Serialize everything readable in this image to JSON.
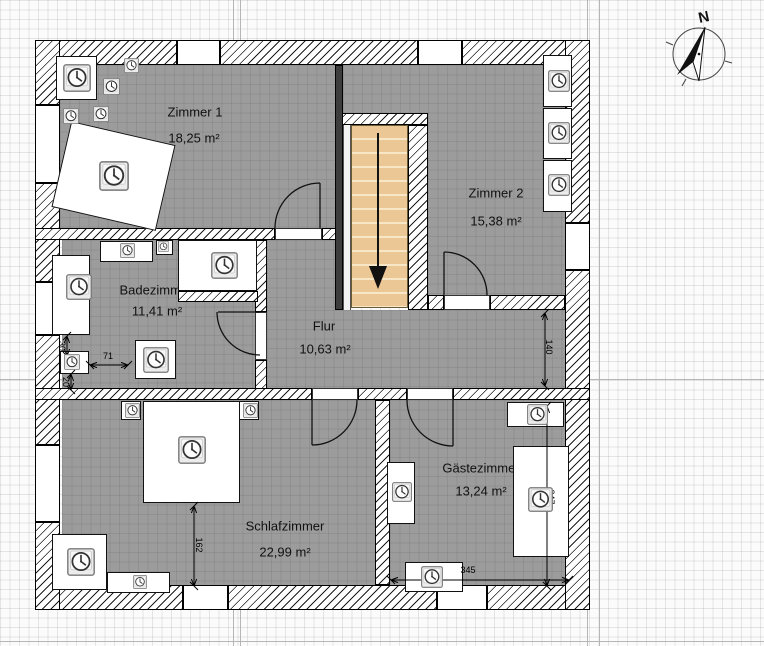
{
  "view": {
    "type": "floor-plan",
    "units": "cm"
  },
  "compass": {
    "label": "N"
  },
  "colors": {
    "room_fill": "#9c9c9c",
    "stair_fill": "#ebc795",
    "wall_hatch": "#1c1c1c",
    "window_fill": "#ffffff",
    "annotation": "#000000"
  },
  "rooms": [
    {
      "id": "zimmer1",
      "name": "Zimmer 1",
      "area": "18,25 m²",
      "label_x": 195,
      "label_y": 112,
      "area_x": 194,
      "area_y": 138
    },
    {
      "id": "zimmer2",
      "name": "Zimmer 2",
      "area": "15,38 m²",
      "label_x": 496,
      "label_y": 193,
      "area_x": 496,
      "area_y": 221
    },
    {
      "id": "badezimmer",
      "name": "Badezimmer",
      "area": "11,41 m²",
      "label_x": 156,
      "label_y": 290,
      "area_x": 157,
      "area_y": 311
    },
    {
      "id": "flur",
      "name": "Flur",
      "area": "10,63 m²",
      "label_x": 324,
      "label_y": 326,
      "area_x": 325,
      "area_y": 349
    },
    {
      "id": "schlafzimmer",
      "name": "Schlafzimmer",
      "area": "22,99 m²",
      "label_x": 285,
      "label_y": 526,
      "area_x": 285,
      "area_y": 552
    },
    {
      "id": "gaestezimmer",
      "name": "Gästezimmer",
      "area": "13,24 m²",
      "label_x": 481,
      "label_y": 468,
      "area_x": 481,
      "area_y": 491
    }
  ],
  "dimensions": [
    {
      "id": "flur-height",
      "value": "140",
      "x1": 545,
      "y1": 313,
      "x2": 545,
      "y2": 386,
      "lx": 549,
      "ly": 347,
      "rot": 90
    },
    {
      "id": "bett-abstand",
      "value": "162",
      "x1": 194,
      "y1": 506,
      "x2": 194,
      "y2": 586,
      "lx": 199,
      "ly": 545,
      "rot": 90
    },
    {
      "id": "gaeste-hoehe",
      "value": "347",
      "x1": 547,
      "y1": 406,
      "x2": 547,
      "y2": 586,
      "lx": 551,
      "ly": 497,
      "rot": 90
    },
    {
      "id": "gaeste-breite",
      "value": "345",
      "x1": 391,
      "y1": 580,
      "x2": 569,
      "y2": 580,
      "lx": 468,
      "ly": 570,
      "rot": 0
    },
    {
      "id": "bad-71",
      "value": "71",
      "x1": 90,
      "y1": 365,
      "x2": 128,
      "y2": 365,
      "lx": 108,
      "ly": 356,
      "rot": 0
    },
    {
      "id": "bad-30",
      "value": "30",
      "x1": 67,
      "y1": 336,
      "x2": 67,
      "y2": 356,
      "lx": 62,
      "ly": 346,
      "rot": 90
    },
    {
      "id": "bad-20",
      "value": "20",
      "x1": 71,
      "y1": 374,
      "x2": 71,
      "y2": 390,
      "lx": 66,
      "ly": 382,
      "rot": 90
    }
  ],
  "furniture": {
    "boxes": [
      {
        "x": 56,
        "y": 56,
        "w": 41,
        "h": 44,
        "rot": 0
      },
      {
        "x": 60,
        "y": 132,
        "w": 107,
        "h": 88,
        "rot": 13
      },
      {
        "x": 543,
        "y": 55,
        "w": 29,
        "h": 52,
        "rot": 0
      },
      {
        "x": 543,
        "y": 108,
        "w": 29,
        "h": 51,
        "rot": 0
      },
      {
        "x": 543,
        "y": 160,
        "w": 29,
        "h": 52,
        "rot": 0
      },
      {
        "x": 100,
        "y": 241,
        "w": 53,
        "h": 21,
        "rot": 0
      },
      {
        "x": 156,
        "y": 240,
        "w": 17,
        "h": 15,
        "rot": 0
      },
      {
        "x": 52,
        "y": 255,
        "w": 38,
        "h": 80,
        "rot": 0
      },
      {
        "x": 178,
        "y": 240,
        "w": 79,
        "h": 51,
        "rot": 0
      },
      {
        "x": 60,
        "y": 351,
        "w": 29,
        "h": 23,
        "rot": 0
      },
      {
        "x": 135,
        "y": 340,
        "w": 41,
        "h": 39,
        "rot": 0
      },
      {
        "x": 143,
        "y": 401,
        "w": 97,
        "h": 102,
        "rot": 0
      },
      {
        "x": 121,
        "y": 401,
        "w": 20,
        "h": 19,
        "rot": 0
      },
      {
        "x": 239,
        "y": 401,
        "w": 20,
        "h": 19,
        "rot": 0
      },
      {
        "x": 52,
        "y": 534,
        "w": 55,
        "h": 56,
        "rot": 0
      },
      {
        "x": 107,
        "y": 572,
        "w": 63,
        "h": 21,
        "rot": 0
      },
      {
        "x": 507,
        "y": 402,
        "w": 57,
        "h": 25,
        "rot": 0
      },
      {
        "x": 513,
        "y": 446,
        "w": 56,
        "h": 111,
        "rot": 0
      },
      {
        "x": 387,
        "y": 462,
        "w": 28,
        "h": 62,
        "rot": 0
      },
      {
        "x": 405,
        "y": 562,
        "w": 58,
        "h": 30,
        "rot": 0
      }
    ],
    "clocks": [
      {
        "x": 63,
        "y": 64,
        "s": 28
      },
      {
        "x": 124,
        "y": 58,
        "s": 15
      },
      {
        "x": 103,
        "y": 78,
        "s": 17
      },
      {
        "x": 93,
        "y": 106,
        "s": 16
      },
      {
        "x": 63,
        "y": 108,
        "s": 16
      },
      {
        "x": 99,
        "y": 161,
        "s": 30
      },
      {
        "x": 548,
        "y": 70,
        "s": 22
      },
      {
        "x": 548,
        "y": 122,
        "s": 22
      },
      {
        "x": 548,
        "y": 174,
        "s": 22
      },
      {
        "x": 120,
        "y": 243,
        "s": 15
      },
      {
        "x": 158,
        "y": 241,
        "s": 11
      },
      {
        "x": 66,
        "y": 274,
        "s": 26
      },
      {
        "x": 211,
        "y": 252,
        "s": 27
      },
      {
        "x": 64,
        "y": 354,
        "s": 16
      },
      {
        "x": 143,
        "y": 347,
        "s": 26
      },
      {
        "x": 178,
        "y": 436,
        "s": 28
      },
      {
        "x": 125,
        "y": 403,
        "s": 15
      },
      {
        "x": 243,
        "y": 403,
        "s": 15
      },
      {
        "x": 67,
        "y": 548,
        "s": 28
      },
      {
        "x": 133,
        "y": 575,
        "s": 14
      },
      {
        "x": 527,
        "y": 404,
        "s": 21
      },
      {
        "x": 528,
        "y": 487,
        "s": 25
      },
      {
        "x": 392,
        "y": 482,
        "s": 20
      },
      {
        "x": 421,
        "y": 566,
        "s": 22
      }
    ]
  }
}
